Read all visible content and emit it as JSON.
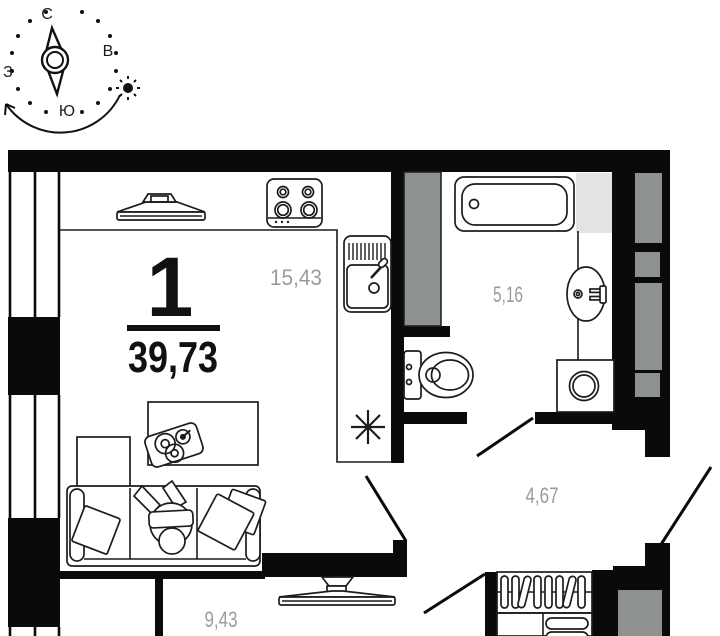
{
  "compass": {
    "north": "С",
    "east": "В",
    "south": "Ю",
    "west": "З"
  },
  "apartment": {
    "number": "1",
    "total_area": "39,73"
  },
  "areas": {
    "kitchen_living": "15,43",
    "bathroom": "5,16",
    "hallway": "4,67",
    "room": "9,43"
  },
  "colors": {
    "wall": "#0a0a0a",
    "line": "#1c1c1c",
    "area_label": "#9b9b9b",
    "shaft_gray": "#8d918f",
    "niche_gray": "#e3e3e3",
    "background": "#ffffff"
  }
}
